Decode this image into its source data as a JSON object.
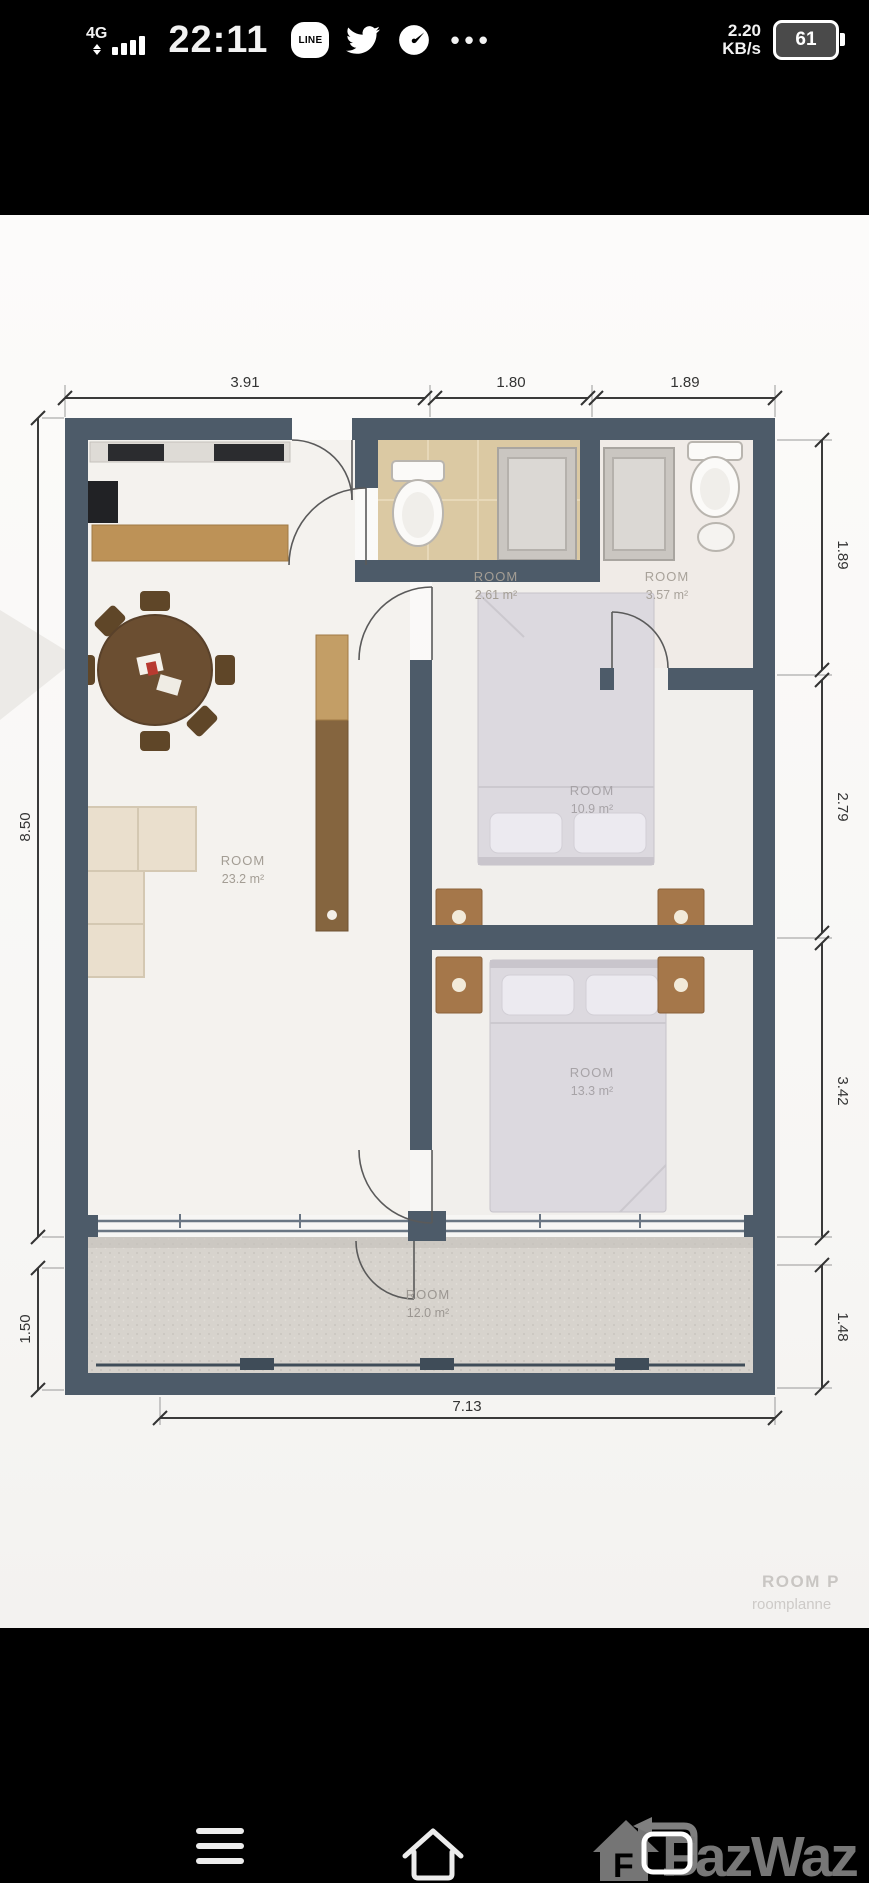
{
  "status_bar": {
    "network": "4G",
    "time": "22:11",
    "line_label": "LINE",
    "more_glyph": "•••",
    "net_speed": "2.20",
    "net_speed_unit": "KB/s",
    "battery_percent": "61"
  },
  "floor_plan": {
    "rooms": [
      {
        "id": "living-room",
        "label": "ROOM",
        "area": "23.2 m²"
      },
      {
        "id": "bathroom-left",
        "label": "ROOM",
        "area": "2.61 m²"
      },
      {
        "id": "bathroom-right",
        "label": "ROOM",
        "area": "3.57 m²"
      },
      {
        "id": "bedroom-middle",
        "label": "ROOM",
        "area": "10.9 m²"
      },
      {
        "id": "bedroom-lower",
        "label": "ROOM",
        "area": "13.3 m²"
      },
      {
        "id": "balcony",
        "label": "ROOM",
        "area": "12.0 m²"
      }
    ],
    "dimensions_m": {
      "top": [
        "3.91",
        "1.80",
        "1.89"
      ],
      "right": [
        "1.89",
        "2.79",
        "3.42",
        "1.48"
      ],
      "left": [
        "8.50",
        "1.50"
      ],
      "bottom": [
        "7.13"
      ]
    },
    "watermark_line1": "ROOM P",
    "watermark_line2": "roomplanne"
  },
  "nav_bar": {
    "brand": "FazWaz",
    "logo_letter": "F"
  },
  "colors": {
    "wall": "#4d5b69",
    "wood_counter": "#bd9257",
    "dining_table": "#6b4e31",
    "nightstand": "#a5774a",
    "bed": "#dcd9df",
    "sofa": "#eadfcd",
    "bathroom_floor": "#dbc9a3",
    "balcony_floor": "#d7d3cd",
    "dimension_text": "#333333",
    "room_label": "#a39d94",
    "watermark": "#c9c6c3",
    "brand_gray": "#828282"
  }
}
